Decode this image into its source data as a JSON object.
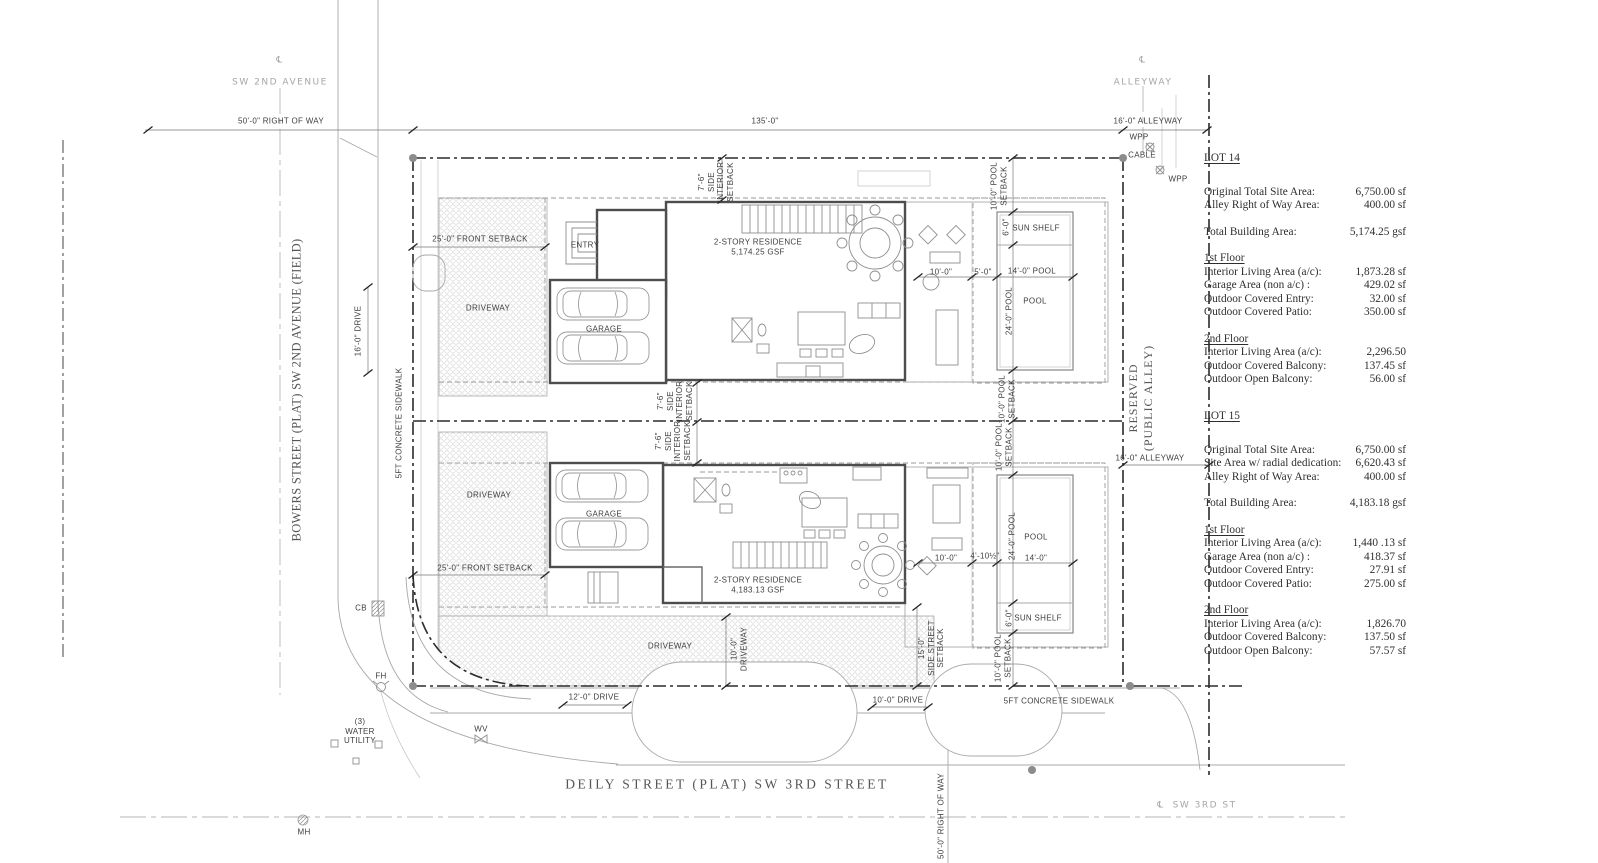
{
  "drawing": {
    "streets": {
      "centerline_symbol": "℄",
      "sw_2nd_avenue": "SW 2ND AVENUE",
      "alleyway": "ALLEYWAY",
      "bowers_street": "BOWERS STREET (PLAT) SW 2ND AVENUE (FIELD)",
      "reserved_public_alley": "RESERVED\n(PUBLIC ALLEY)",
      "deily_street": "DEILY STREET (PLAT) SW 3RD STREET",
      "sw_3rd_street": "SW 3RD ST"
    },
    "dims": {
      "row_50_top": "50'-0\" RIGHT OF WAY",
      "row_50_bottom": "50'-0\" RIGHT OF WAY",
      "lot_width_135": "135'-0\"",
      "alleyway_16_top": "16'-0\" ALLEYWAY",
      "alleyway_16_mid": "16'-0\" ALLEYWAY",
      "drive_16": "16'-0\" DRIVE",
      "drive_12": "12'-0\" DRIVE",
      "drive_10": "10'-0\" DRIVE",
      "sidewalk_left": "5FT CONCRETE SIDEWALK",
      "sidewalk_bottom": "5FT CONCRETE SIDEWALK"
    },
    "lot14": {
      "front_setback": "25'-0\" FRONT SETBACK",
      "side_setback": "7'-6\"\nSIDE\nINTERIOR\nSETBACK",
      "driveway": "DRIVEWAY",
      "entry": "ENTRY",
      "garage": "GARAGE",
      "residence": "2-STORY RESIDENCE\n5,174.25 GSF",
      "pool_setback": "10'-0\" POOL\nSETBACK",
      "sun_shelf": "SUN SHELF",
      "pool": "POOL",
      "dim_6": "6'-0\"",
      "dim_10": "10'-0\"",
      "dim_5": "5'-0\"",
      "dim_14_pool": "14'-0\" POOL",
      "dim_24_pool": "24'-0\" POOL"
    },
    "lot15": {
      "front_setback": "25'-0\" FRONT SETBACK",
      "side_setback": "7'-6\"\nSIDE\nINTERIOR\nSETBACK",
      "side_street_setback": "15'-0\"\nSIDE STREET\nSETBACK",
      "driveway_upper": "DRIVEWAY",
      "driveway_lower": "DRIVEWAY",
      "driveway_dim": "10'-0\"\nDRIVEWAY",
      "garage": "GARAGE",
      "residence": "2-STORY RESIDENCE\n4,183.13 GSF",
      "pool_setback": "10'-0\" POOL\nSETBACK",
      "sun_shelf": "SUN SHELF",
      "pool": "POOL",
      "dim_6": "6'-0\"",
      "dim_10": "10'-0\"",
      "dim_4_10": "4'-10½\"",
      "dim_14": "14'-0\"",
      "dim_24_pool": "24'-0\" POOL"
    },
    "utilities": {
      "wpp": "WPP",
      "cable": "CABLE",
      "cb": "CB",
      "fh": "FH",
      "water_utility": "(3)\nWATER\nUTILITY",
      "wv": "WV",
      "mh": "MH"
    }
  },
  "tables": {
    "lot14": {
      "title": "LOT 14",
      "site_rows": [
        {
          "label": "Original Total Site Area:",
          "value": "6,750.00 sf"
        },
        {
          "label": "Alley Right of Way Area:",
          "value": "400.00 sf"
        }
      ],
      "total": {
        "label": "Total Building Area:",
        "value": "5,174.25 gsf"
      },
      "first_floor": {
        "heading": "1st Floor",
        "rows": [
          {
            "label": "Interior Living Area (a/c):",
            "value": "1,873.28 sf"
          },
          {
            "label": "Garage Area (non a/c) :",
            "value": "429.02 sf"
          },
          {
            "label": "Outdoor Covered Entry:",
            "value": "32.00 sf"
          },
          {
            "label": "Outdoor Covered Patio:",
            "value": "350.00 sf"
          }
        ]
      },
      "second_floor": {
        "heading": "2nd Floor",
        "rows": [
          {
            "label": "Interior Living Area (a/c):",
            "value": "2,296.50"
          },
          {
            "label": "Outdoor Covered Balcony:",
            "value": "137.45 sf"
          },
          {
            "label": "Outdoor Open Balcony:",
            "value": "56.00 sf"
          }
        ]
      }
    },
    "lot15": {
      "title": "LOT 15",
      "site_rows": [
        {
          "label": "Original Total Site Area:",
          "value": "6,750.00 sf"
        },
        {
          "label": "Site Area w/ radial dedication:",
          "value": "6,620.43 sf"
        },
        {
          "label": "Alley Right of Way Area:",
          "value": "400.00 sf"
        }
      ],
      "total": {
        "label": "Total Building Area:",
        "value": "4,183.18 gsf"
      },
      "first_floor": {
        "heading": "1st Floor",
        "rows": [
          {
            "label": "Interior Living Area (a/c):",
            "value": "1,440 .13 sf"
          },
          {
            "label": "Garage Area (non a/c) :",
            "value": "418.37 sf"
          },
          {
            "label": "Outdoor Covered Entry:",
            "value": "27.91 sf"
          },
          {
            "label": "Outdoor Covered Patio:",
            "value": "275.00 sf"
          }
        ]
      },
      "second_floor": {
        "heading": "2nd Floor",
        "rows": [
          {
            "label": "Interior Living Area (a/c):",
            "value": "1,826.70"
          },
          {
            "label": "Outdoor Covered Balcony:",
            "value": "137.50 sf"
          },
          {
            "label": "Outdoor Open Balcony:",
            "value": "57.57 sf"
          }
        ]
      }
    }
  }
}
